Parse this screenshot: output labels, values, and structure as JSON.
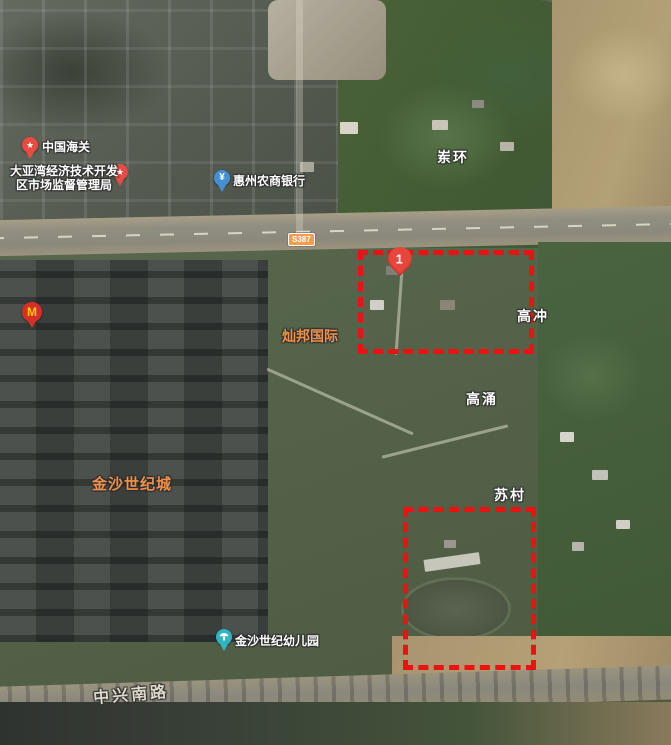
{
  "pois": {
    "customs": {
      "label": "中国海关"
    },
    "market_bureau": {
      "line1": "大亚湾经济技术开发",
      "line2": "区市场监督管理局"
    },
    "bank": {
      "label": "惠州农商银行",
      "icon_glyph": "¥"
    },
    "kindergarten": {
      "label": "金沙世纪幼儿园"
    },
    "mcdonalds": {
      "icon_glyph": "M"
    }
  },
  "places": {
    "donghuan": "岽环",
    "gaochong": "高冲",
    "gaoyong": "高涌",
    "sucun": "苏村",
    "canbang_intl": "灿邦国际",
    "jinsha_century_city": "金沙世纪城"
  },
  "roads": {
    "badge_label": "S387",
    "zhongxing_south_road": "中兴南路"
  },
  "annotations": {
    "marker_number": "1"
  },
  "glyphs": {
    "star": "★"
  },
  "colors": {
    "annotation_red": "#ec1212",
    "poi_pin_red": "#e94a42",
    "bank_pin_blue": "#4590d4",
    "kindergarten_pin_teal": "#2fb4c4",
    "mcdonalds_red": "#d62f27",
    "orange_label": "#f0914d",
    "badge_orange": "#f69c4e"
  }
}
